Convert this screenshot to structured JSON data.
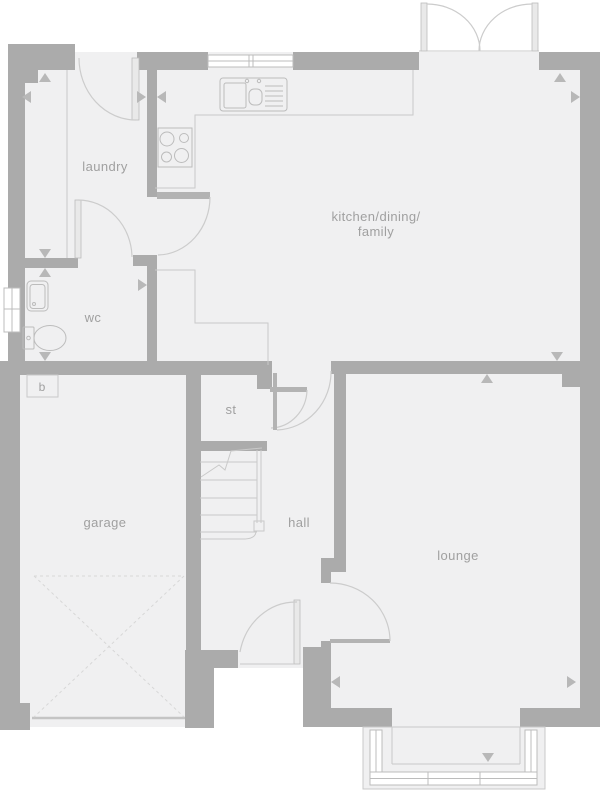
{
  "colors": {
    "wall": "#ababab",
    "floor": "#f0f0f1",
    "line": "#c9c9c9",
    "arc": "#cccccc",
    "fixture": "#bcbcbc",
    "tri": "#b8b8b8",
    "label": "#a0a0a0"
  },
  "rooms": {
    "laundry": {
      "label": "laundry"
    },
    "kitchen": {
      "label_line1": "kitchen/dining/",
      "label_line2": "family"
    },
    "wc": {
      "label": "wc"
    },
    "store": {
      "label": "st"
    },
    "garage": {
      "label": "garage"
    },
    "hall": {
      "label": "hall"
    },
    "lounge": {
      "label": "lounge"
    }
  },
  "fixtures": {
    "boiler": {
      "label": "b"
    }
  }
}
